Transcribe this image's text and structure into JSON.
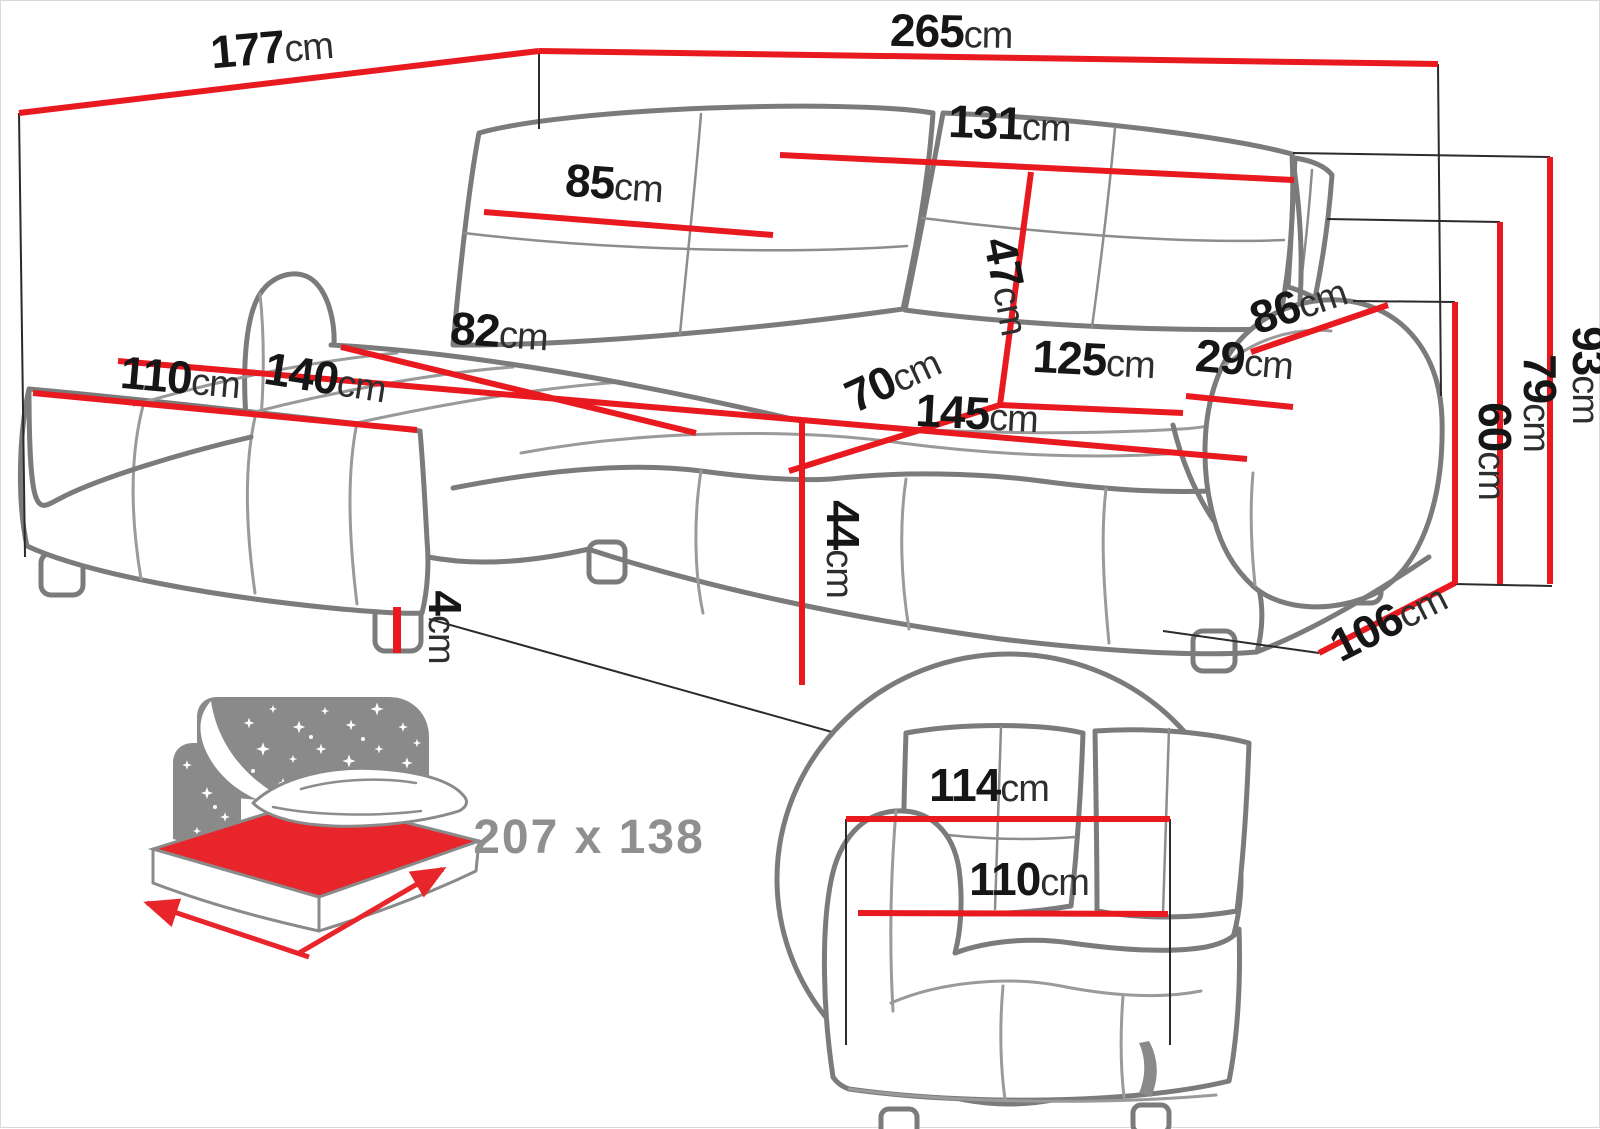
{
  "diagram_type": "corner-sofa dimension drawing",
  "measurements": {
    "m177": {
      "num": "177",
      "unit": "cm"
    },
    "m265": {
      "num": "265",
      "unit": "cm"
    },
    "m131": {
      "num": "131",
      "unit": "cm"
    },
    "m85": {
      "num": "85",
      "unit": "cm"
    },
    "m47": {
      "num": "47",
      "unit": "cm"
    },
    "m82": {
      "num": "82",
      "unit": "cm"
    },
    "m110": {
      "num": "110",
      "unit": "cm"
    },
    "m140": {
      "num": "140",
      "unit": "cm"
    },
    "m70": {
      "num": "70",
      "unit": "cm"
    },
    "m125": {
      "num": "125",
      "unit": "cm"
    },
    "m29": {
      "num": "29",
      "unit": "cm"
    },
    "m86": {
      "num": "86",
      "unit": "cm"
    },
    "m145": {
      "num": "145",
      "unit": "cm"
    },
    "m44": {
      "num": "44",
      "unit": "cm"
    },
    "m4": {
      "num": "4",
      "unit": "cm"
    },
    "m93": {
      "num": "93",
      "unit": "cm"
    },
    "m79": {
      "num": "79",
      "unit": "cm"
    },
    "m60": {
      "num": "60",
      "unit": "cm"
    },
    "m106": {
      "num": "106",
      "unit": "cm"
    },
    "m114": {
      "num": "114",
      "unit": "cm"
    },
    "m110b": {
      "num": "110",
      "unit": "cm"
    }
  },
  "sleeping_area": {
    "value": "207 x 138"
  },
  "icons": {
    "sleep_function": "bed-with-starry-headboard-icon",
    "detail_view": "magnified-armrest-circle"
  },
  "colors": {
    "dimension_red": "#e8191f",
    "mattress_red": "#e8252b",
    "sofa_outline_gray": "#7b7b7b",
    "icon_gray": "#8a8a8a",
    "label_black": "#161616"
  }
}
